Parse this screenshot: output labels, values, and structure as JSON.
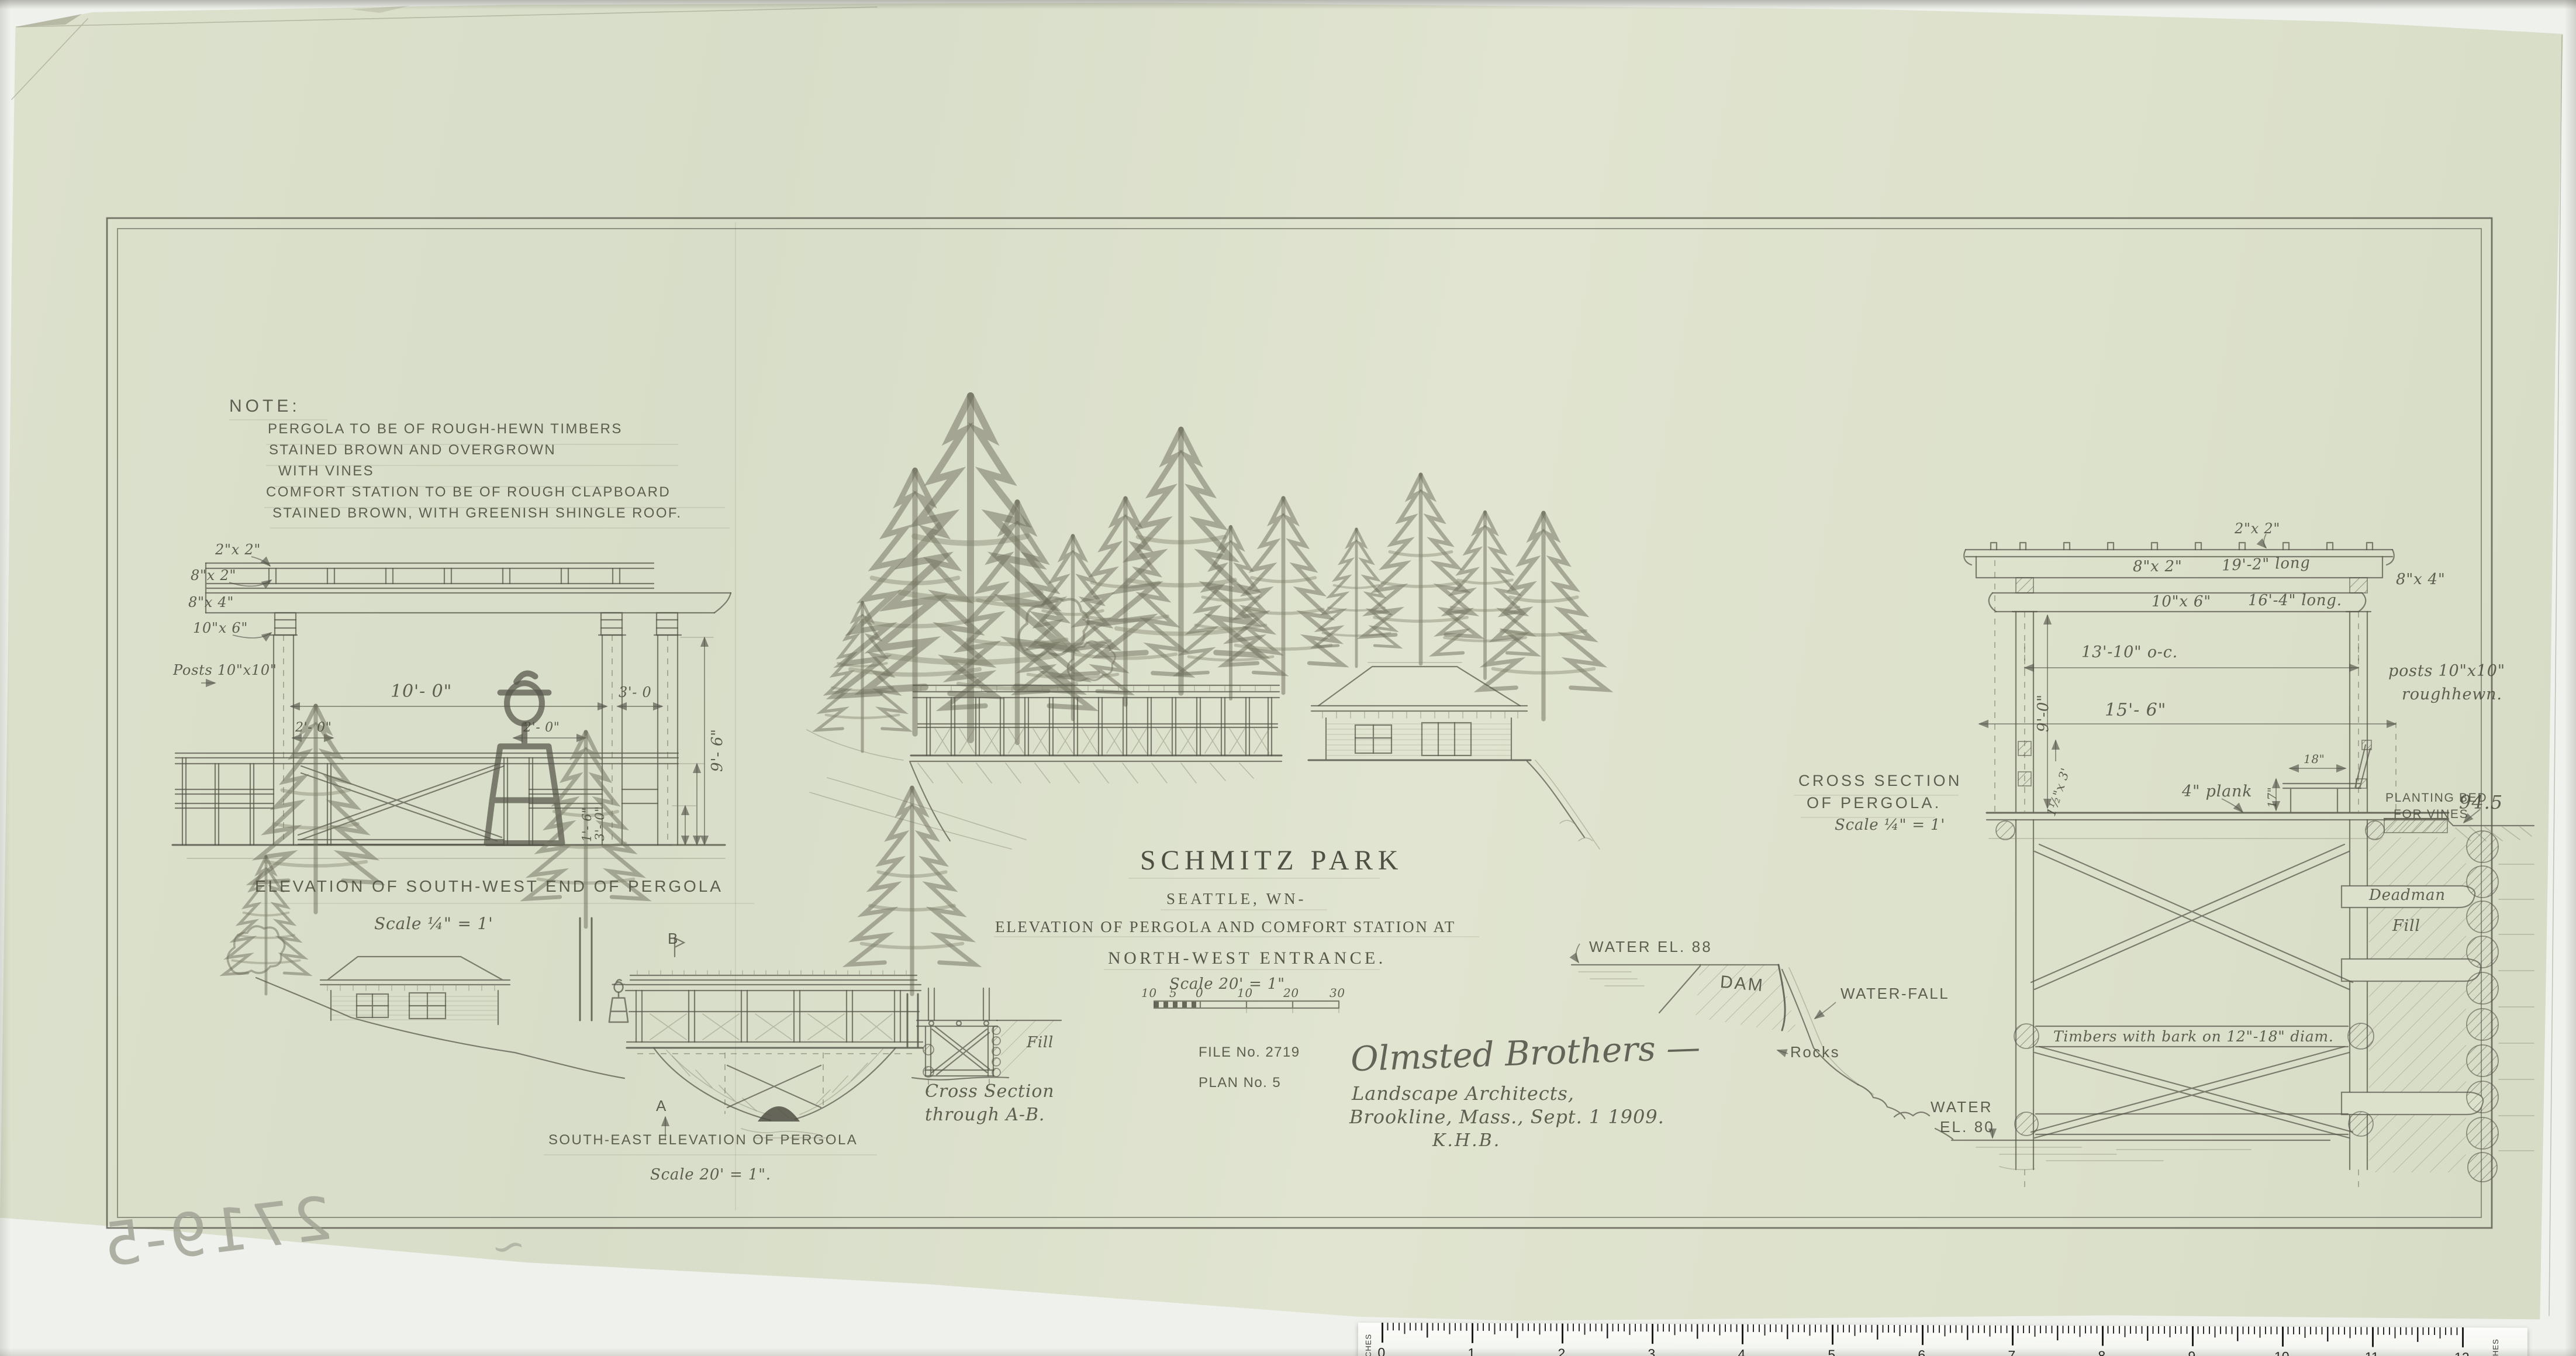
{
  "colors": {
    "paper": "#dce1cc",
    "pencil": "#55544a",
    "stamp": "#9fa193"
  },
  "note": {
    "heading": "NOTE:",
    "lines": [
      "PERGOLA TO BE OF ROUGH-HEWN TIMBERS",
      "STAINED BROWN AND OVERGROWN",
      "WITH VINES",
      "COMFORT STATION TO BE OF ROUGH CLAPBOARD",
      "STAINED BROWN, WITH GREENISH SHINGLE ROOF."
    ]
  },
  "title_block": {
    "park": "SCHMITZ PARK",
    "city": "SEATTLE, WN-",
    "line1": "ELEVATION OF PERGOLA AND COMFORT STATION AT",
    "line2": "NORTH-WEST ENTRANCE.",
    "scale": "Scale 20' = 1\"",
    "bar_numbers": [
      "10",
      "5",
      "0",
      "10",
      "20",
      "30"
    ]
  },
  "file_block": {
    "file_no": "FILE No. 2719",
    "plan_no": "PLAN No. 5"
  },
  "signature": {
    "name": "Olmsted Brothers —",
    "line1": "Landscape Architects,",
    "line2": "Brookline, Mass., Sept. 1 1909.",
    "initials": "K.H.B."
  },
  "sw_elevation": {
    "caption": "ELEVATION OF SOUTH-WEST END OF PERGOLA",
    "scale": "Scale ¼\" = 1'",
    "dims": {
      "d2x2": "2\"x 2\"",
      "d8x2": "8\"x 2\"",
      "d8x4": "8\"x 4\"",
      "d10x6": "10\"x 6\"",
      "posts": "Posts 10\"x10\"",
      "span": "10'- 0\"",
      "bay": "3'- 0",
      "left2": "2'- 0\"",
      "right2": "2'- 0\"",
      "v16": "1'- 6\"",
      "v30": "3'- 0\"",
      "v96": "9'- 6\""
    }
  },
  "se_elevation": {
    "caption": "SOUTH-EAST ELEVATION OF PERGOLA",
    "scale": "Scale 20' = 1\".",
    "marker_a": "A",
    "marker_b": "B"
  },
  "xsec_ab": {
    "line1": "Cross Section",
    "line2": "through A-B.",
    "fill": "Fill"
  },
  "water": {
    "el88": "WATER EL. 88",
    "dam": "DAM",
    "waterfall": "WATER-FALL",
    "rocks": "Rocks",
    "water_lc": "WATER",
    "el80": "EL. 80"
  },
  "xsec_pergola": {
    "caption1": "CROSS SECTION",
    "caption2": "OF PERGOLA.",
    "scale": "Scale ¼\" = 1'",
    "dims": {
      "top2x2": "2\"x 2\"",
      "beam8x2": "8\"x 2\"",
      "len192": "19'-2\" long",
      "s8x4": "8\"x 4\"",
      "beam10x6": "10\"x 6\"",
      "len164": "16'-4\" long.",
      "oc": "13'-10\" o-c.",
      "v90": "9'-0\"",
      "w156": "15'- 6\"",
      "posts1": "posts 10\"x10\"",
      "posts2": "roughhewn.",
      "small": "1½\"x 3'",
      "d18": "18\"",
      "d17": "17\"",
      "plank": "4\" plank",
      "bed1": "PLANTING BED",
      "bed2": "FOR VINES",
      "elev945": "94.5",
      "deadman": "Deadman",
      "fill": "Fill",
      "timbers": "Timbers with bark on 12\"-18\" diam."
    }
  },
  "ruler": {
    "unit_label": "INCHES",
    "numbers": [
      "0",
      "1",
      "2",
      "3",
      "4",
      "5",
      "6",
      "7",
      "8",
      "9",
      "10",
      "11",
      "12"
    ]
  },
  "stamp": {
    "number": "2719-5",
    "tick": "~"
  }
}
